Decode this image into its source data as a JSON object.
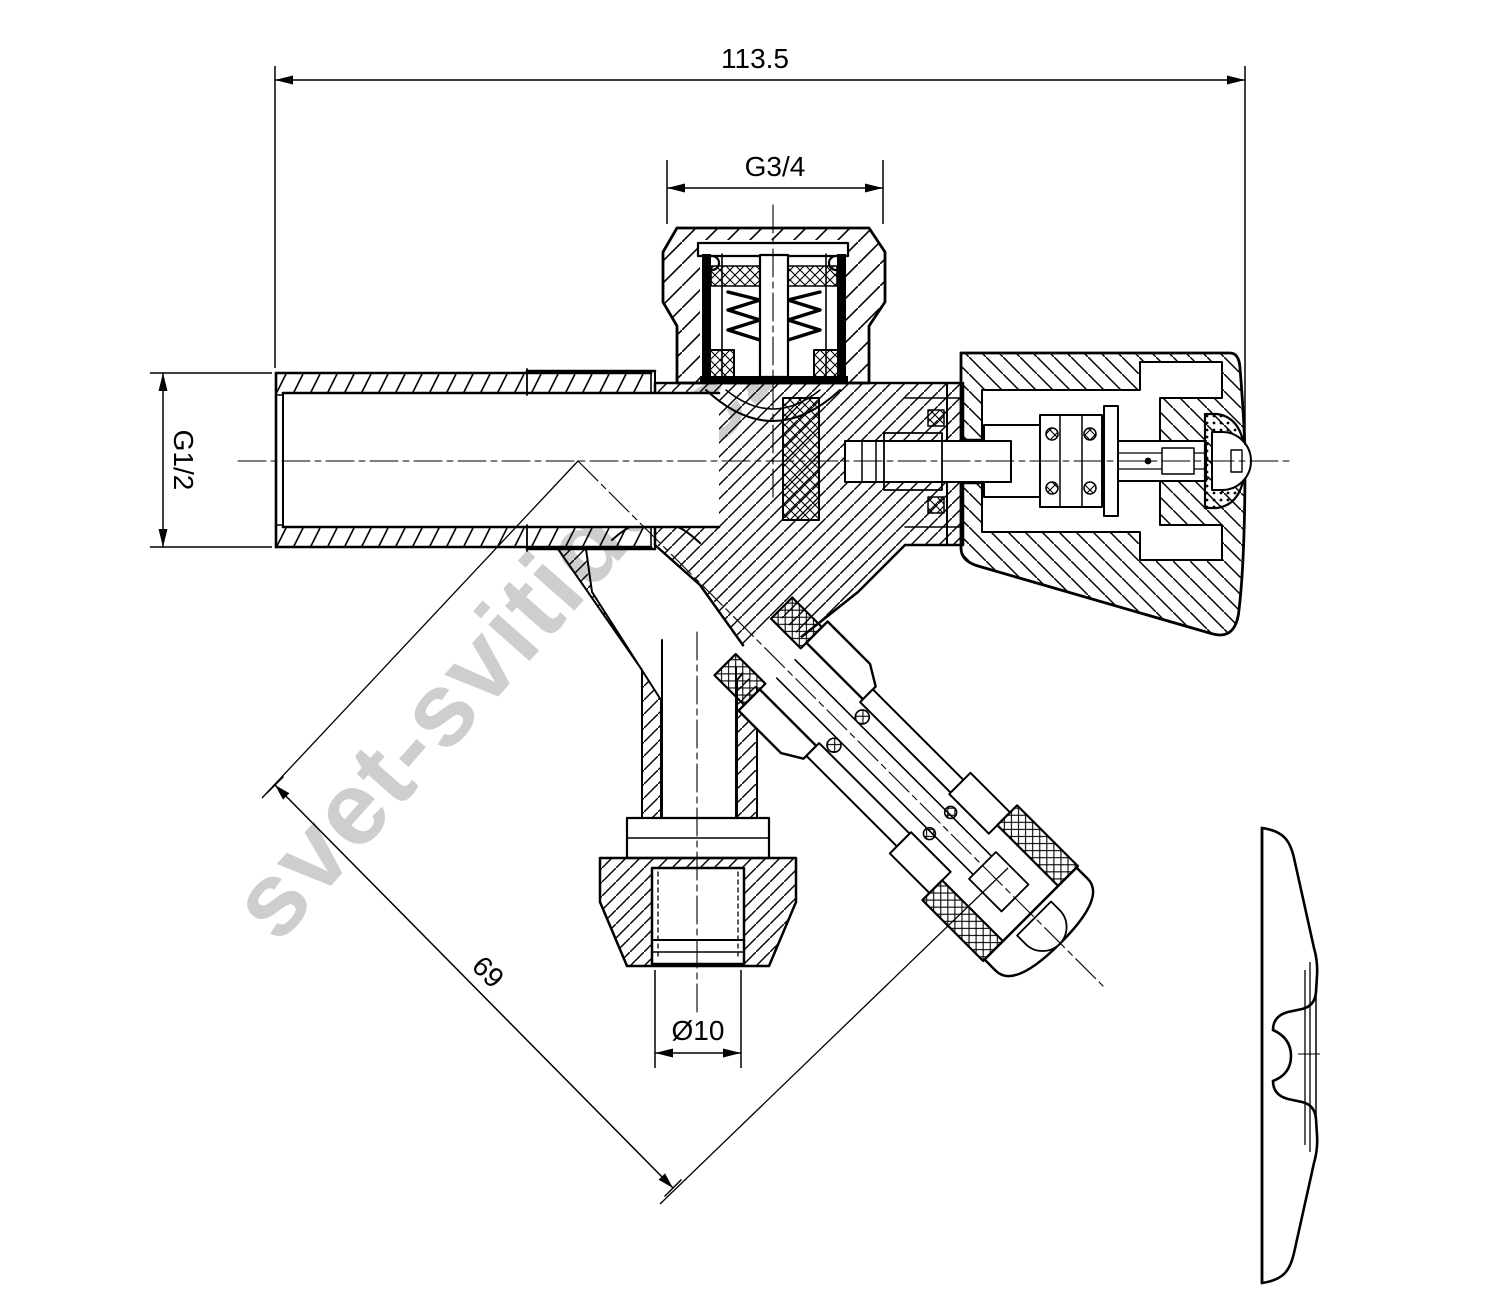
{
  "watermark": {
    "text": "svet-svitidel.cz"
  },
  "dimensions": {
    "overall_width": "113.5",
    "top_connection": "G3/4",
    "inlet_connection": "G1/2",
    "spout_length": "69",
    "outlet_diameter": "Ø10"
  },
  "colors": {
    "line": "#000000",
    "background": "#ffffff",
    "watermark": "#c9c9c9"
  }
}
